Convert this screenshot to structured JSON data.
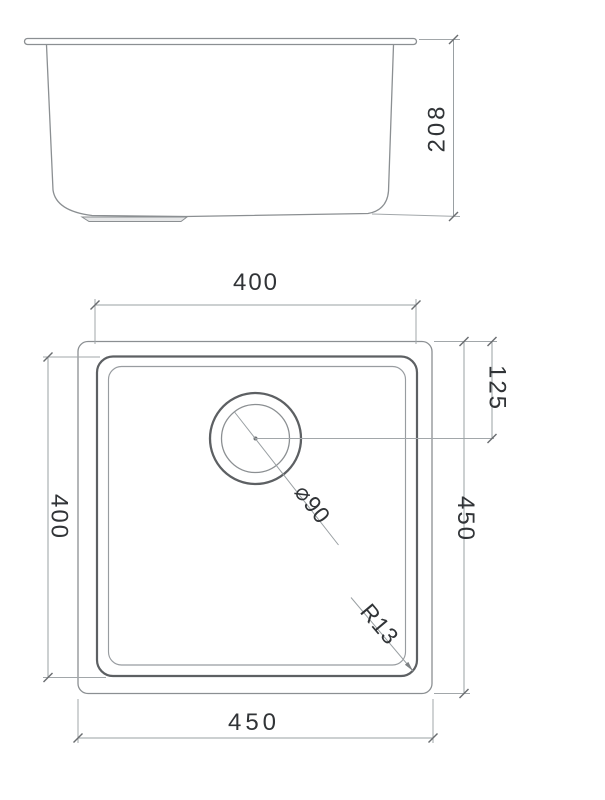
{
  "side_view": {
    "height_dim": "208"
  },
  "plan_view": {
    "bowl_width_dim": "400",
    "bowl_depth_dim": "400",
    "drain_offset_dim": "125",
    "overall_depth_dim": "450",
    "overall_width_dim": "450",
    "drain_diameter_label": "⌀90",
    "corner_radius_label": "R13"
  },
  "colors": {
    "line_gray": "#9aa0a3",
    "outline_gray": "#8b8f92",
    "heavy_gray": "#5d6063",
    "text_dark": "#313437",
    "background": "#ffffff"
  }
}
